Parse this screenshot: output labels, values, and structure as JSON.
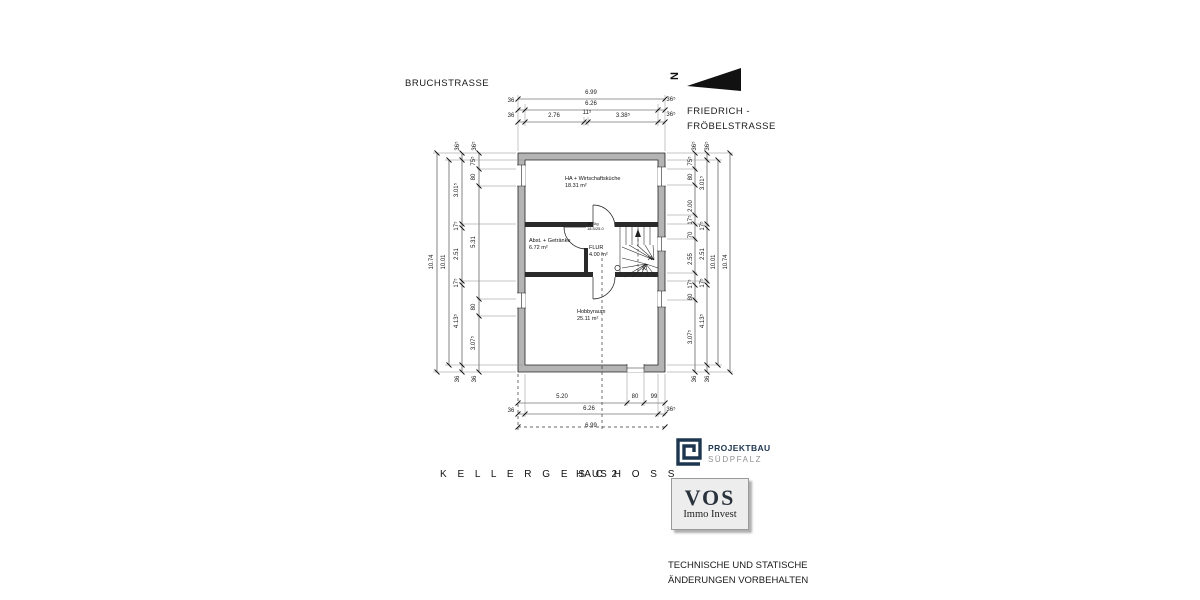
{
  "streets": {
    "top": "BRUCHSTRASSE",
    "right_line1": "FRIEDRICH -",
    "right_line2": "FRÖBELSTRASSE"
  },
  "north": {
    "label": "N"
  },
  "rooms": [
    {
      "name": "HA + Wirtschaftsküche",
      "area": "18.31 m²"
    },
    {
      "name": "Abst. + Getränke",
      "area": "6.72 m²"
    },
    {
      "name": "FLUR",
      "area": "4.00 m²"
    },
    {
      "name": "Hobbyraum",
      "area": "25.11 m²"
    }
  ],
  "stair": {
    "line1": "16 Stg",
    "line2": "18.5/25.0"
  },
  "dims": {
    "top": {
      "total": "6.99",
      "inner": "6.26",
      "segs": [
        "2.76",
        "11⁵",
        "3.38⁵"
      ],
      "wl": [
        "36",
        "36"
      ],
      "wr": [
        "36⁵",
        "36⁵"
      ]
    },
    "bottom": {
      "segs": [
        "5.20",
        "80",
        "99"
      ],
      "inner": "6.26",
      "total": "6.99",
      "wl": "36",
      "wr": "36⁵"
    },
    "left": {
      "total": "10.74",
      "inner": "10.01",
      "rooms": [
        "3.01⁵",
        "17⁵",
        "2.51",
        "17⁵",
        "4.13⁵"
      ],
      "openings": [
        "75⁵",
        "80",
        "5.31",
        "80",
        "3.07⁵"
      ],
      "t36": [
        "36⁵",
        "36⁵"
      ],
      "b36": [
        "36",
        "36"
      ]
    },
    "right": {
      "total": "10.74",
      "inner": "10.01",
      "rooms": [
        "3.01⁵",
        "17⁵",
        "2.51",
        "17⁵",
        "4.13⁵"
      ],
      "openings": [
        "75⁵",
        "80",
        "2.00",
        "17⁵",
        "70",
        "2.55",
        "17⁵",
        "80",
        "3.07⁵"
      ],
      "t36": [
        "36⁵",
        "36⁵"
      ],
      "b36": [
        "36",
        "36"
      ]
    }
  },
  "title": {
    "main": "K E L L E R G E S C H O S S",
    "sub": "HAUS 2"
  },
  "logos": {
    "projektbau": {
      "line1": "PROJEKTBAU",
      "line2": "SÜDPFALZ",
      "navy": "#1d3650",
      "gray": "#919191"
    },
    "vos": {
      "line1": "VOS",
      "line2": "Immo Invest"
    }
  },
  "disclaimer": {
    "line1": "TECHNISCHE UND STATISCHE",
    "line2": "ÄNDERUNGEN VORBEHALTEN"
  }
}
